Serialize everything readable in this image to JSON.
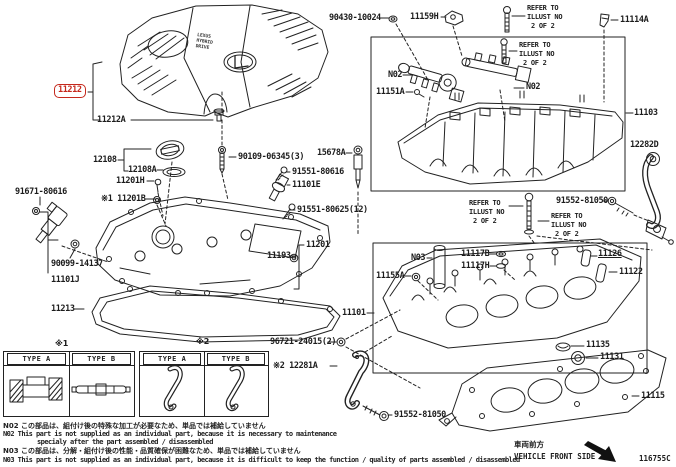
{
  "doc_code": "116755C",
  "highlight_color": "#c5281c",
  "cover": {
    "line1": "LEXUS",
    "line2": "HYBRID",
    "line3": "DRIVE"
  },
  "refer_note": [
    "REFER TO",
    "ILLUST NO",
    "2 OF 2"
  ],
  "parts": {
    "p90430_10024": "90430-10024",
    "p11159H": "11159H",
    "p11114A": "11114A",
    "n02": "N02",
    "p11151A": "11151A",
    "p11103": "11103",
    "p12282D": "12282D",
    "p91552_81050": "91552-81050",
    "p11117B": "11117B",
    "p11117H": "11117H",
    "n03": "N03",
    "p11155A": "11155A",
    "p11126": "11126",
    "p11122": "11122",
    "p11101": "11101",
    "p11135": "11135",
    "p11131": "11131",
    "p11115": "11115",
    "p11212": "11212",
    "p11212A": "11212A",
    "p12108": "12108",
    "p12108A": "12108A",
    "p11201H": "11201H",
    "p11201B": "※1 11201B",
    "p91671_80616": "91671-80616",
    "p90109_06345": "90109-06345(3)",
    "p15678A": "15678A",
    "p91551_80616": "91551-80616",
    "p11101E": "11101E",
    "p91551_80625": "91551-80625(12)",
    "p11201": "11201",
    "p11193": "11193",
    "p90099_14137": "90099-14137",
    "p11101J": "11101J",
    "p11213": "11213",
    "p96721_24015": "96721-24015(2)",
    "p12281A": "※2 12281A"
  },
  "tables": {
    "ref1": "※1",
    "ref2": "※2",
    "type_a": "TYPE A",
    "type_b": "TYPE B"
  },
  "notes": {
    "n02_jp": "N02 この部品は、組付け後の特殊な加工が必要なため、単品では補給していません",
    "n02_en1": "N02 This part is not supplied as an individual part, because it is necessary to maintenance",
    "n02_en2": "specialy after the part assembled / disassembled",
    "n03_jp": "N03 この部品は、分解・組付け後の性能・品質確保が困難なため、単品では補給していません",
    "n03_en": "N03 This part is not supplied as an individual part, because it is difficult to keep the function / quality of parts  assembled / disassembled"
  },
  "footer": {
    "front_side_jp": "車両前方",
    "front_side_en": "VEHICLE FRONT SIDE"
  }
}
